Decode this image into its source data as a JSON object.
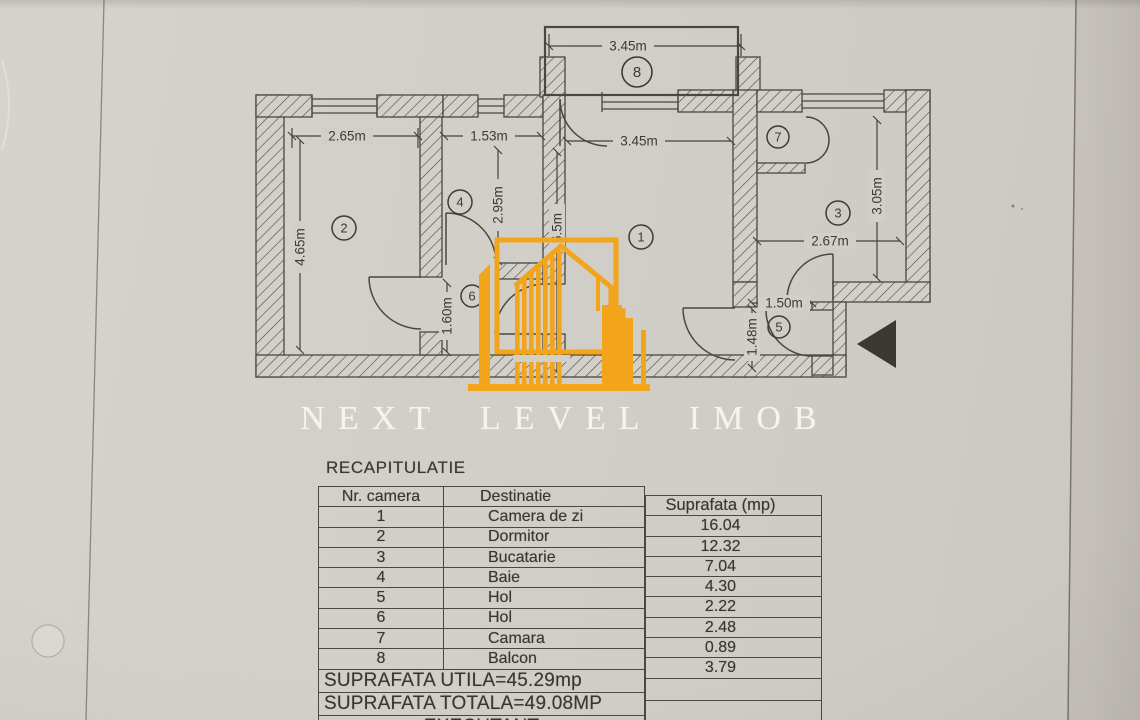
{
  "brand": {
    "name": "NEXT LEVEL IMOB",
    "accent_color": "#F2A41B"
  },
  "plan": {
    "room_numbers": {
      "r1": "1",
      "r2": "2",
      "r3": "3",
      "r4": "4",
      "r5": "5",
      "r6": "6",
      "r7": "7",
      "r8": "8"
    },
    "dims": {
      "balcony_w": "3.45m",
      "dorm_w": "2.65m",
      "bath_w": "1.53m",
      "living_w": "3.45m",
      "kitchen_w": "2.67m",
      "hall5_w": "1.50m",
      "dorm_h": "4.65m",
      "bath_h": "2.95m",
      "living_h": "6.5m",
      "kitchen_h": "3.05m",
      "hall5_h": "1.48m",
      "hall6_h": "1.60m"
    }
  },
  "recap": {
    "title": "RECAPITULATIE",
    "col_nr": "Nr. camera",
    "col_dest": "Destinatie",
    "col_sup": "Suprafata (mp)",
    "rows": [
      {
        "nr": "1",
        "dest": "Camera de zi",
        "mp": "16.04"
      },
      {
        "nr": "2",
        "dest": "Dormitor",
        "mp": "12.32"
      },
      {
        "nr": "3",
        "dest": "Bucatarie",
        "mp": "7.04"
      },
      {
        "nr": "4",
        "dest": "Baie",
        "mp": "4.30"
      },
      {
        "nr": "5",
        "dest": "Hol",
        "mp": "2.22"
      },
      {
        "nr": "6",
        "dest": "Hol",
        "mp": "2.48"
      },
      {
        "nr": "7",
        "dest": "Camara",
        "mp": "0.89"
      },
      {
        "nr": "8",
        "dest": "Balcon",
        "mp": "3.79"
      }
    ],
    "suprafata_utila": "SUPRAFATA UTILA=45.29mp",
    "suprafata_totala": "SUPRAFATA TOTALA=49.08MP",
    "executant": "EXECUTANT"
  }
}
